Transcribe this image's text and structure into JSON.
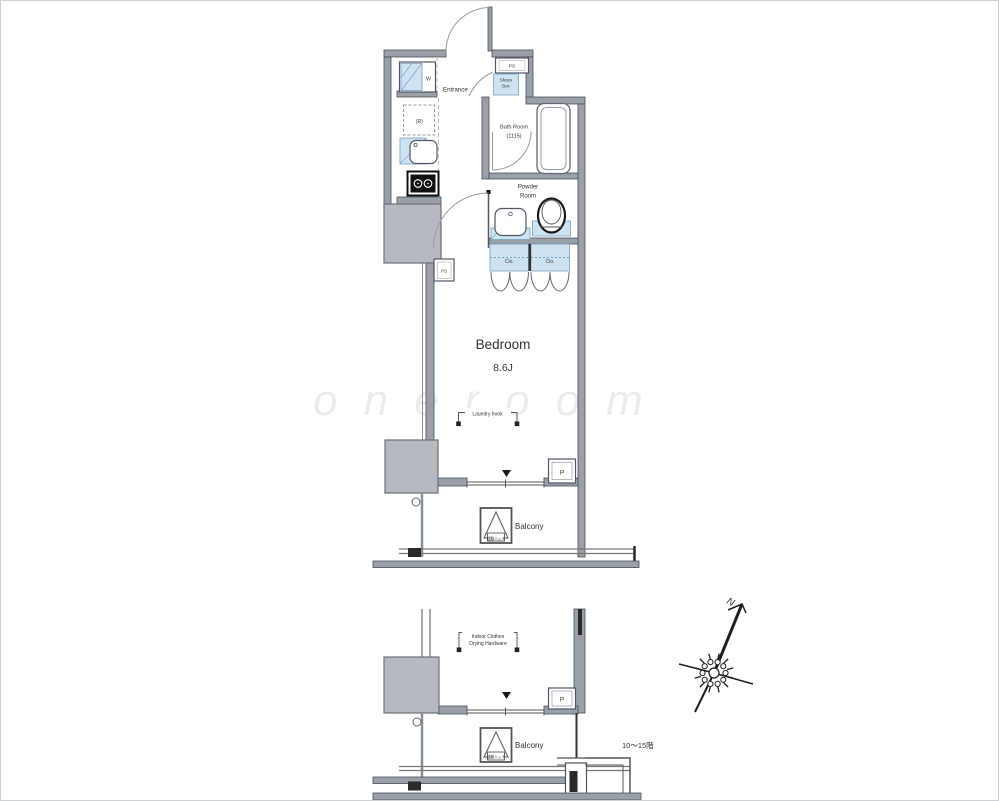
{
  "colors": {
    "wall_gray": "#9aa0a8",
    "pillar_gray": "#b6bac0",
    "fixture_blue": "#cde3f2",
    "outline": "#4a4f55",
    "accent_black": "#2a2a2a"
  },
  "upper_plan": {
    "entrance_label": "Entrance",
    "ps_top_label": "PS",
    "shoes_box_label_line1": "Shoes",
    "shoes_box_label_line2": "Box",
    "washer_label": "W",
    "fridge_label": "(R)",
    "bath_label_line1": "Bath Room",
    "bath_label_line2": "(1115)",
    "powder_label_line1": "Powder",
    "powder_label_line2": "Room",
    "closet_left_label": "Clo.",
    "closet_right_label": "Clo.",
    "ps_mid_label": "PS",
    "bedroom_label": "Bedroom",
    "bedroom_size_label": "8.6J",
    "laundry_hook_label": "Laundry hook",
    "meter_box_label": "P",
    "evacuation_hatch_label": "避難ハッチ",
    "balcony_label": "Balcony"
  },
  "lower_plan": {
    "drying_label_line1": "Indoor Clothes",
    "drying_label_line2": "Drying Hardware",
    "meter_box_label": "P",
    "evacuation_hatch_label": "避難ハッチ",
    "balcony_label": "Balcony",
    "floor_range_note": "10〜15階"
  },
  "compass": {
    "north_label": "N"
  },
  "watermark_text": "oneroom"
}
